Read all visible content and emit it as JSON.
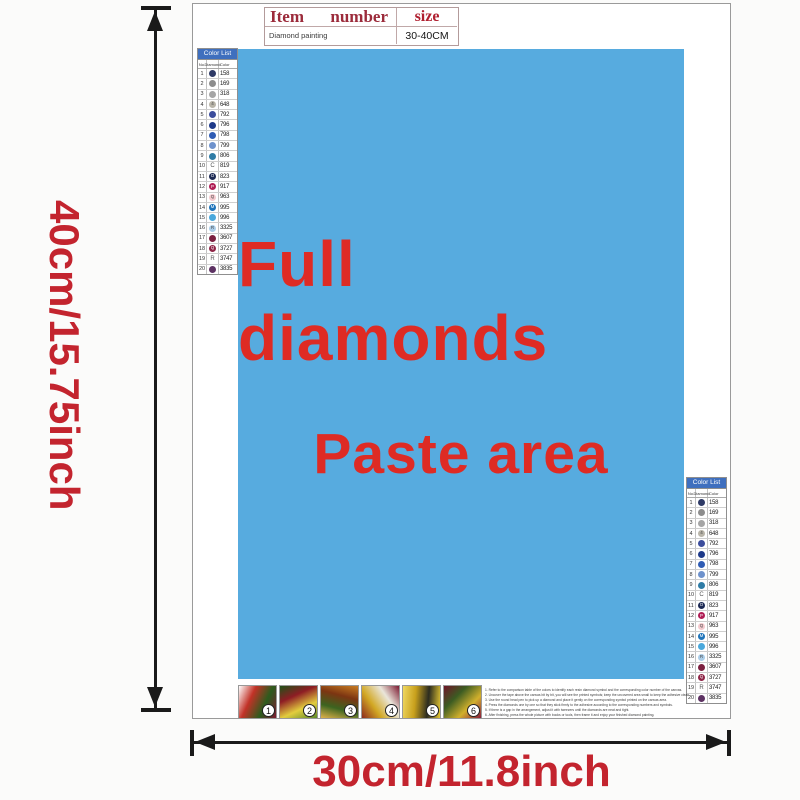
{
  "info_table": {
    "header_item": "Item",
    "header_number": "number",
    "header_size": "size",
    "row_item": "Diamond painting",
    "row_size": "30-40CM"
  },
  "paste_area": {
    "line1": "Full diamonds",
    "line2": "Paste area",
    "bg_color": "#57abdf",
    "text_color": "#de2b24"
  },
  "dimensions": {
    "height_label": "40cm/15.75inch",
    "width_label": "30cm/11.8inch",
    "label_color": "#c3242e"
  },
  "color_list": {
    "title": "Color List",
    "columns": [
      "No.",
      "Diamond",
      "Color"
    ],
    "banner_color": "#3f6fbe",
    "rows": [
      {
        "no": "1",
        "symbol": "",
        "code": "158",
        "dot": "#2e3a66",
        "light": false
      },
      {
        "no": "2",
        "symbol": "",
        "code": "169",
        "dot": "#8d8d8d",
        "light": false
      },
      {
        "no": "3",
        "symbol": "",
        "code": "318",
        "dot": "#a5a5a5",
        "light": false
      },
      {
        "no": "4",
        "symbol": "4",
        "code": "648",
        "dot": "#b9b5a9",
        "light": true
      },
      {
        "no": "5",
        "symbol": "",
        "code": "792",
        "dot": "#3c4d9c",
        "light": false
      },
      {
        "no": "6",
        "symbol": "",
        "code": "796",
        "dot": "#1e3a8a",
        "light": false
      },
      {
        "no": "7",
        "symbol": "",
        "code": "798",
        "dot": "#2f5cb4",
        "light": false
      },
      {
        "no": "8",
        "symbol": "",
        "code": "799",
        "dot": "#6e92cc",
        "light": false
      },
      {
        "no": "9",
        "symbol": "",
        "code": "806",
        "dot": "#2f7ca6",
        "light": false
      },
      {
        "no": "10",
        "symbol": "C",
        "code": "819",
        "dot": "",
        "light": true
      },
      {
        "no": "11",
        "symbol": "O",
        "code": "823",
        "dot": "#1d2a54",
        "light": false
      },
      {
        "no": "12",
        "symbol": "P",
        "code": "917",
        "dot": "#b01e55",
        "light": false
      },
      {
        "no": "13",
        "symbol": "Q",
        "code": "963",
        "dot": "#f3c9ce",
        "light": true
      },
      {
        "no": "14",
        "symbol": "M",
        "code": "995",
        "dot": "#1f74ba",
        "light": false
      },
      {
        "no": "15",
        "symbol": "",
        "code": "996",
        "dot": "#4aa8dc",
        "light": false
      },
      {
        "no": "16",
        "symbol": "R",
        "code": "3325",
        "dot": "#abcde8",
        "light": true
      },
      {
        "no": "17",
        "symbol": "",
        "code": "3607",
        "dot": "#7c2040",
        "light": false
      },
      {
        "no": "18",
        "symbol": "Q",
        "code": "3727",
        "dot": "#8e2446",
        "light": false
      },
      {
        "no": "19",
        "symbol": "R",
        "code": "3747",
        "dot": "",
        "light": true
      },
      {
        "no": "20",
        "symbol": "",
        "code": "3835",
        "dot": "#5d3263",
        "light": false
      }
    ]
  },
  "steps": {
    "tiles": [
      {
        "number": "1",
        "colors": [
          "#ffffff",
          "#c23227",
          "#2c5c1d",
          "#7e1b31"
        ]
      },
      {
        "number": "2",
        "colors": [
          "#1f5218",
          "#8e1d24",
          "#e3cd3e",
          "#5c8a2a"
        ]
      },
      {
        "number": "3",
        "colors": [
          "#c87c22",
          "#7c3512",
          "#3c6420",
          "#e0b24a"
        ]
      },
      {
        "number": "4",
        "colors": [
          "#7c1a32",
          "#eae6da",
          "#d2a824",
          "#8c2a1c"
        ]
      },
      {
        "number": "5",
        "colors": [
          "#e6c832",
          "#2c2c20",
          "#c8a01c",
          "#f0d860"
        ]
      },
      {
        "number": "6",
        "colors": [
          "#8c1c3c",
          "#d2b02c",
          "#3c5c22",
          "#6e1428"
        ]
      }
    ]
  },
  "instructions": {
    "lines": [
      "1.  Refer to the comparison table of the colors to identify each resin diamond symbol and the corresponding color number of the canvas.",
      "2.  Uncover the tape above the canvas bit by bit, you will see the printed symbols; keep the uncovered area small to keep the adhesive clean.",
      "3.  Use the round head pen to pick up a diamond and place it gently on the corresponding symbol printed on the canvas area.",
      "4.  Press the diamonds one by one so that they stick firmly to the adhesive according to the corresponding numbers and symbols.",
      "5.  If there is a gap in the arrangement, adjust it with tweezers until the diamonds are neat and tight.",
      "6.  After finishing, press the whole picture with books or tools, then frame it and enjoy your finished diamond painting."
    ]
  }
}
